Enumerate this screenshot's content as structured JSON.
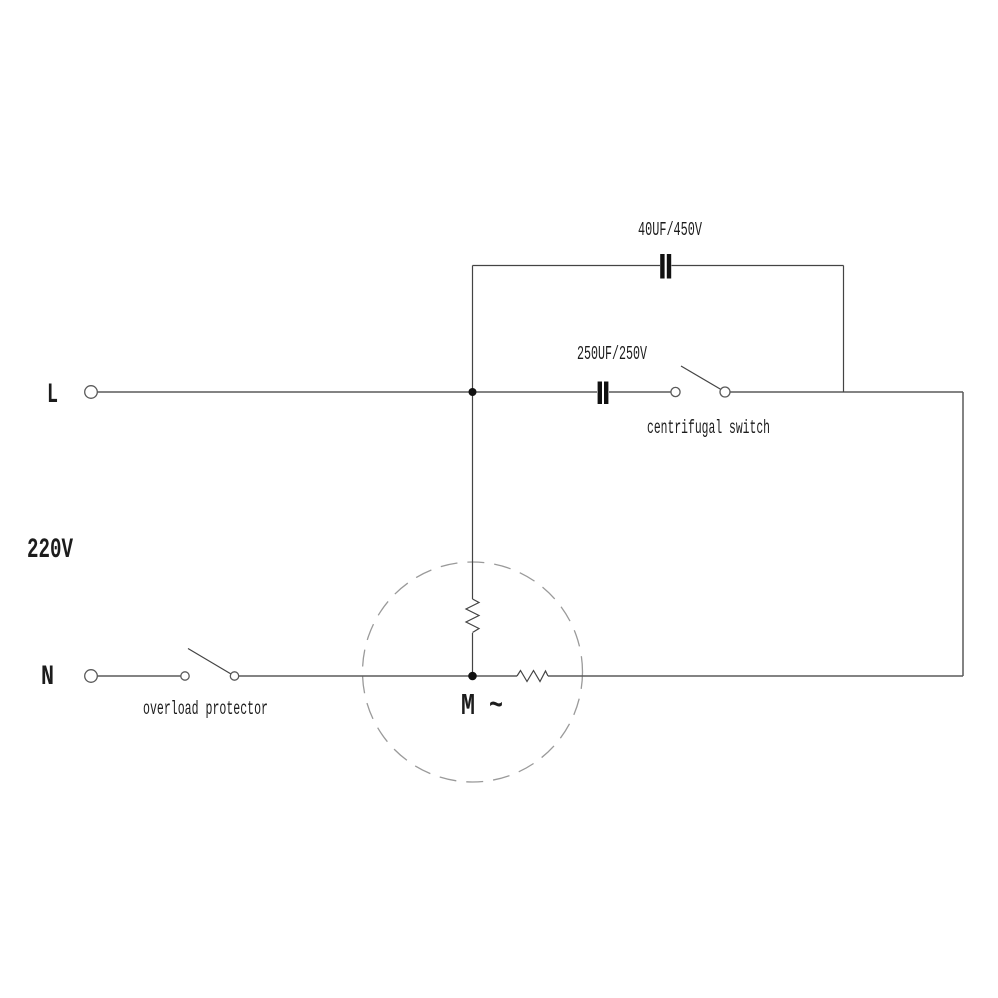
{
  "diagram": {
    "title": "single-phase motor wiring diagram",
    "background_color": "#ffffff",
    "wire_color": "#5a5a5a",
    "text_color": "#1c1c1c",
    "motor_outline_color": "#9a9a9a",
    "labels": {
      "line_terminal": "L",
      "neutral_terminal": "N",
      "supply_voltage": "220V",
      "run_capacitor": "40UF/450V",
      "start_capacitor": "250UF/250V",
      "centrifugal_switch": "centrifugal switch",
      "overload_protector": "overload protector",
      "motor": "M ~"
    }
  }
}
